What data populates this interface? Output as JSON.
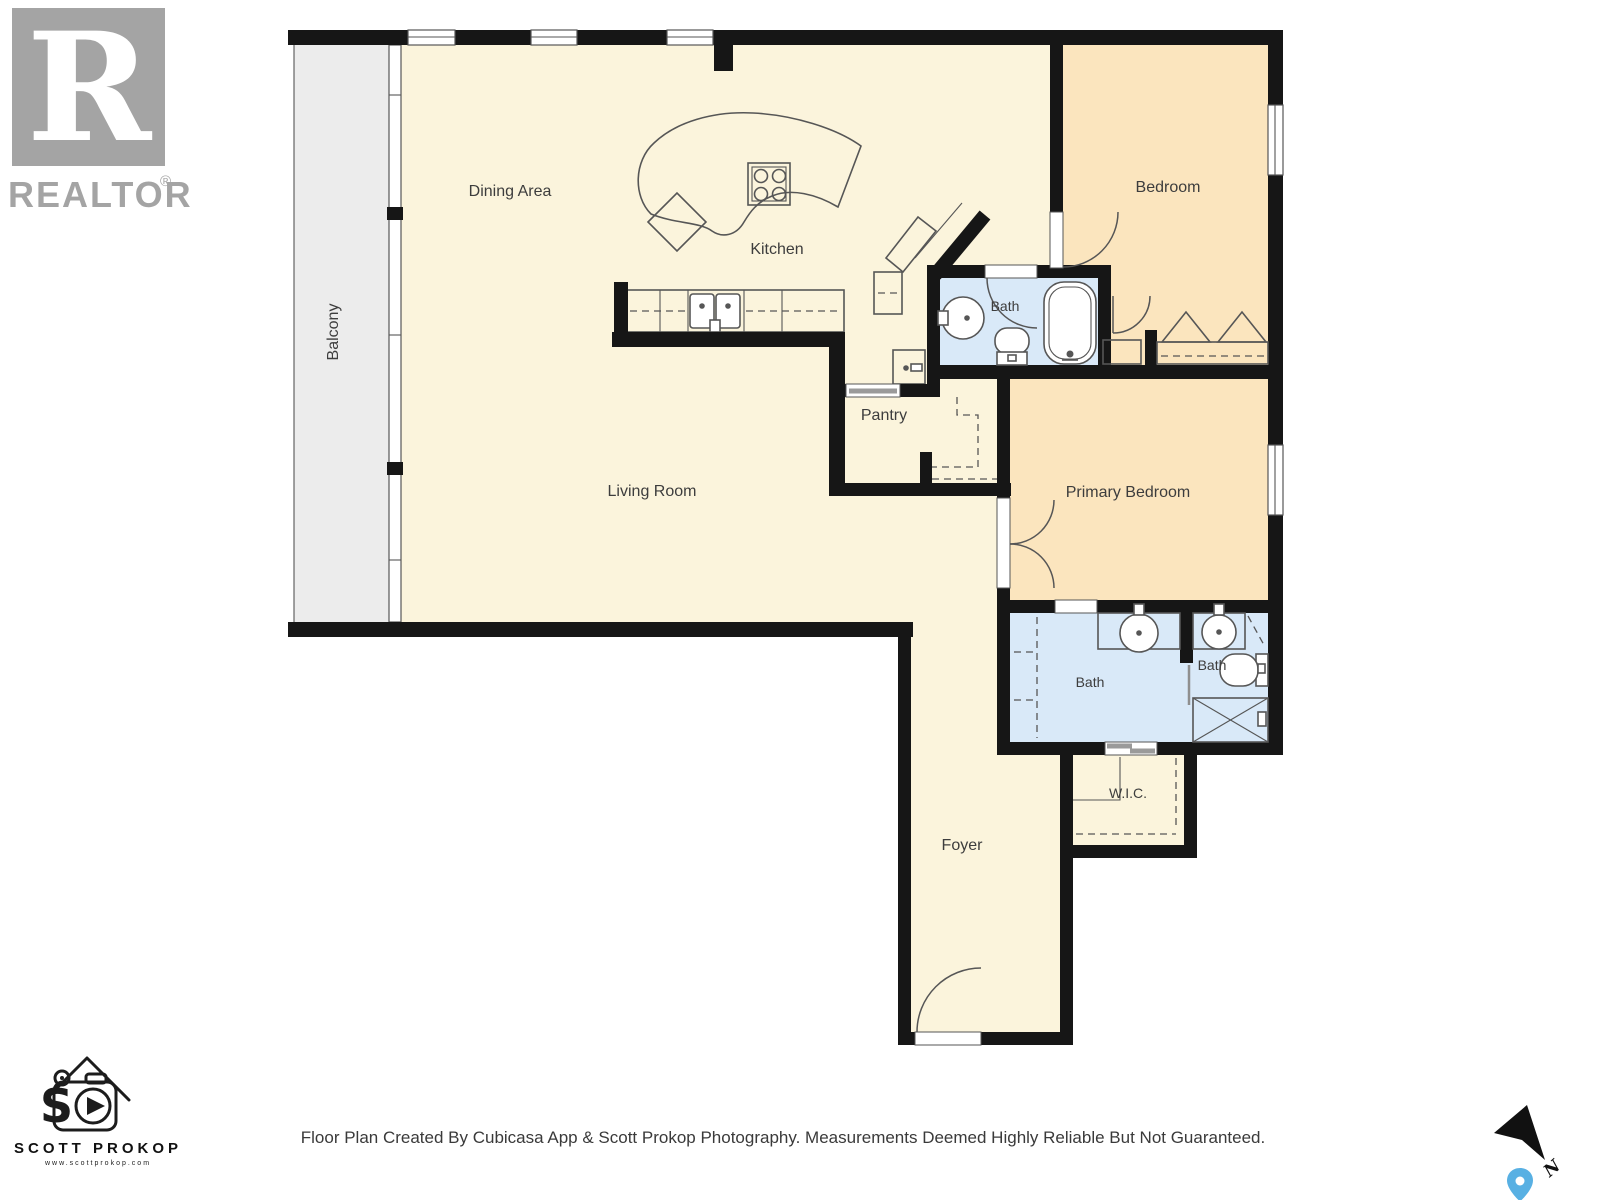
{
  "branding": {
    "realtor": {
      "logo_letter": "R",
      "label": "REALTOR",
      "registered": "®"
    },
    "photographer": {
      "initials": "S",
      "name": "SCOTT PROKOP",
      "website": "www.scottprokop.com"
    }
  },
  "rooms": {
    "balcony": "Balcony",
    "dining": "Dining Area",
    "kitchen": "Kitchen",
    "living": "Living Room",
    "pantry": "Pantry",
    "bedroom": "Bedroom",
    "bath_top": "Bath",
    "primary_bedroom": "Primary Bedroom",
    "bath_ensuite": "Bath",
    "bath_second": "Bath",
    "wic": "W.I.C.",
    "foyer": "Foyer"
  },
  "compass": {
    "north_label": "N"
  },
  "footer": {
    "disclaimer": "Floor Plan Created By Cubicasa App & Scott Prokop Photography. Measurements Deemed Highly Reliable But Not Guaranteed."
  },
  "colors": {
    "wall": "#161616",
    "floor_main": "#FBF4DC",
    "floor_bedroom": "#FBE5BE",
    "floor_bath": "#D9E9F8",
    "floor_balcony": "#ECECEC",
    "fixture_line": "#565656",
    "label": "#3d3d3d",
    "pin": "#58B0E3",
    "logo_gray": "#A4A4A4"
  }
}
